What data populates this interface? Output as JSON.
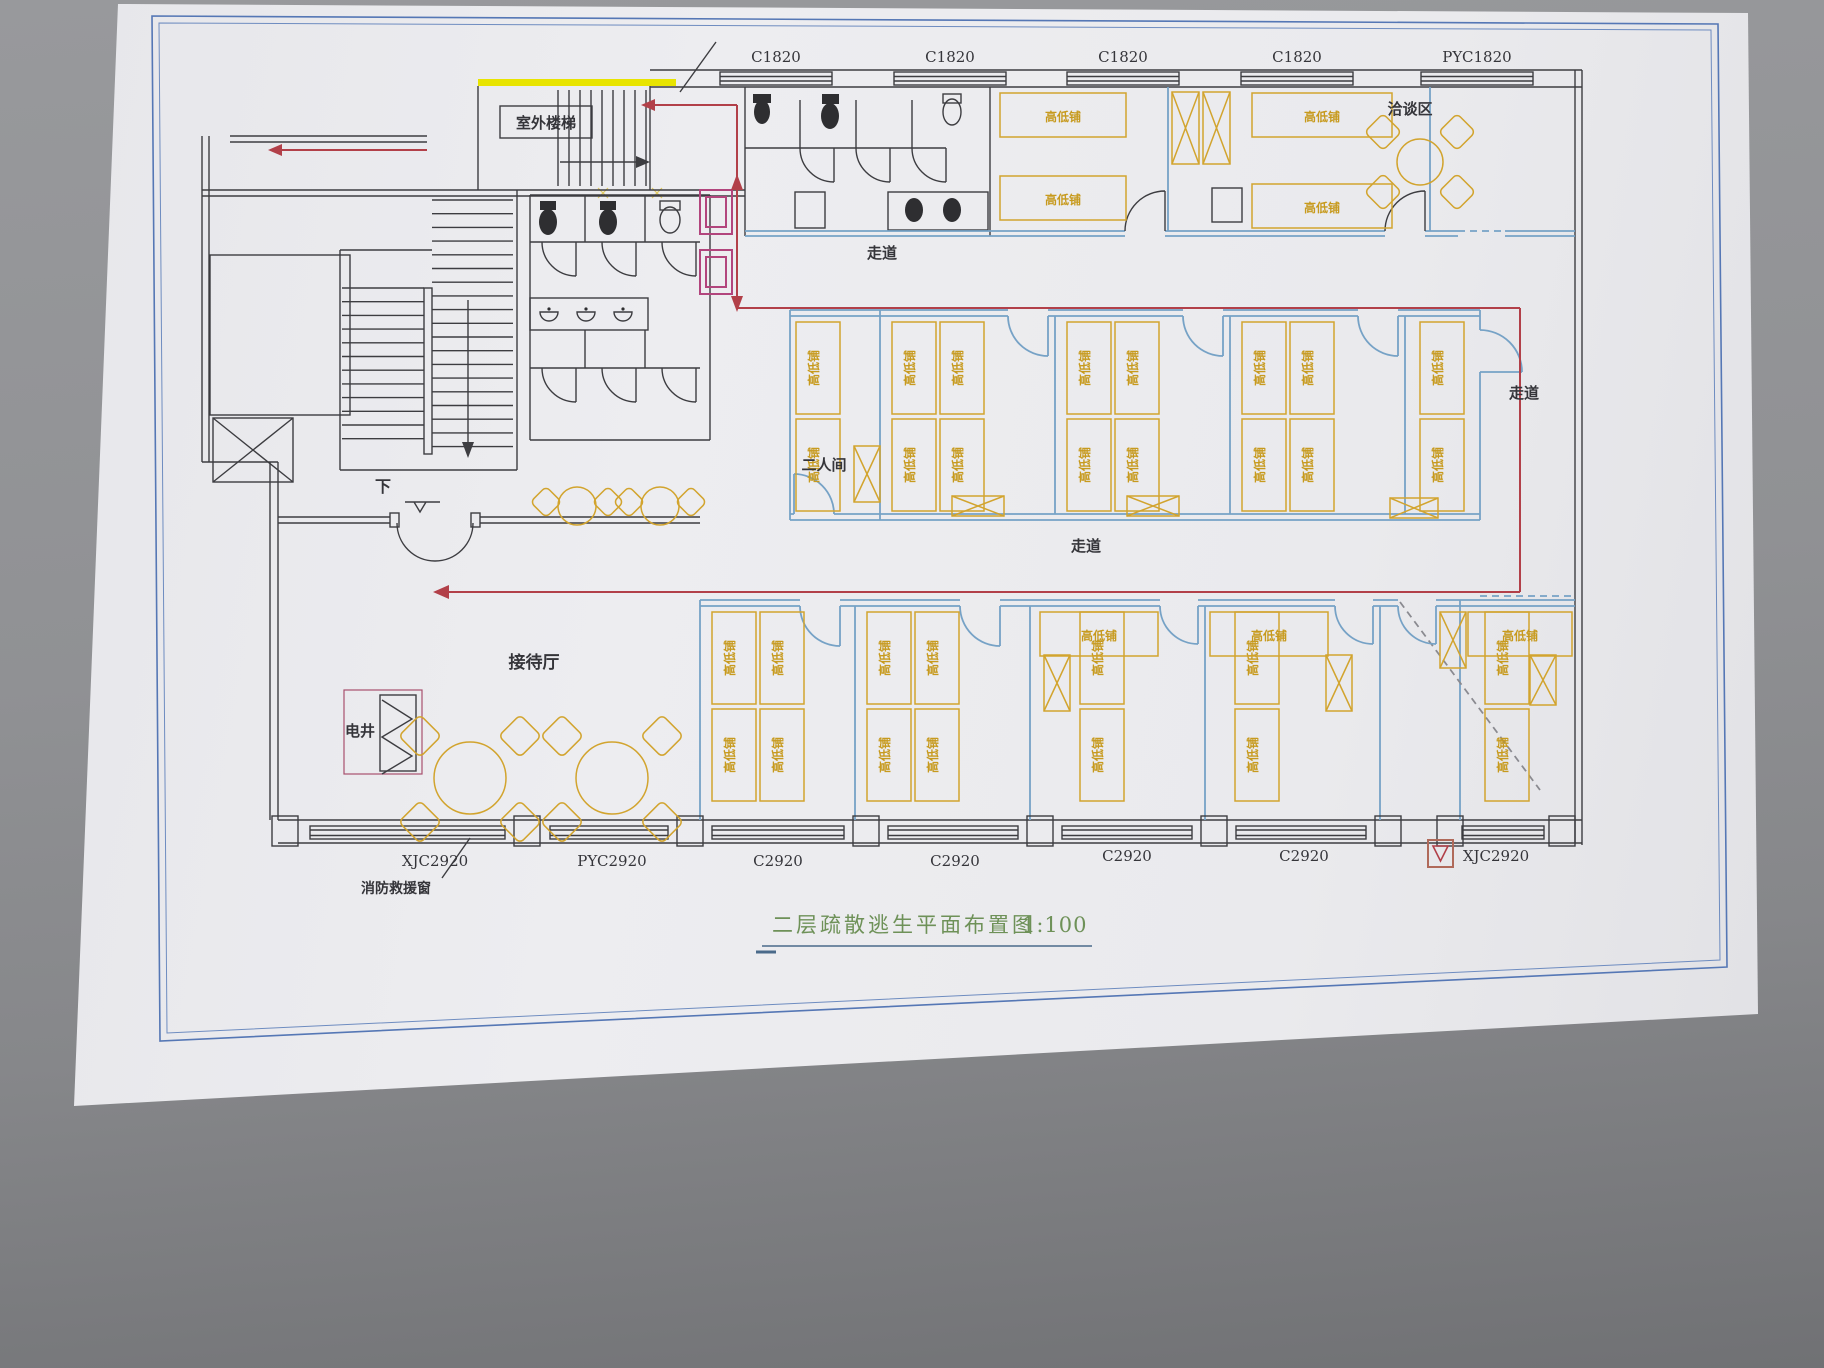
{
  "scene": {
    "background": "#8d8e91",
    "paper_color": "#ebebee"
  },
  "title": {
    "text": "二层疏散逃生平面布置图",
    "scale": "1:100"
  },
  "plan": {
    "rooms": {
      "outdoor_stair": "室外楼梯",
      "negotiation_area": "洽谈区",
      "corridor": "走道",
      "two_person_room": "二人间",
      "reception_hall": "接待厅",
      "electric_shaft": "电井",
      "down": "下"
    },
    "notes": {
      "fire_rescue_window": "消防救援窗"
    },
    "furniture": {
      "bunk_bed": "高低铺"
    },
    "windows": {
      "top": [
        "C1820",
        "C1820",
        "C1820",
        "C1820",
        "PYC1820"
      ],
      "bottom": [
        "XJC2920",
        "PYC2920",
        "C2920",
        "C2920",
        "C2920",
        "C2920",
        "XJC2920"
      ]
    },
    "colors": {
      "walls": "#3d3d41",
      "partitions": "#76a2c6",
      "furniture": "#d2a42e",
      "route": "#b24049",
      "title_text": "#6e9158",
      "stair_highlight": "#e8e400",
      "shaft_marker": "#b2457d"
    }
  }
}
